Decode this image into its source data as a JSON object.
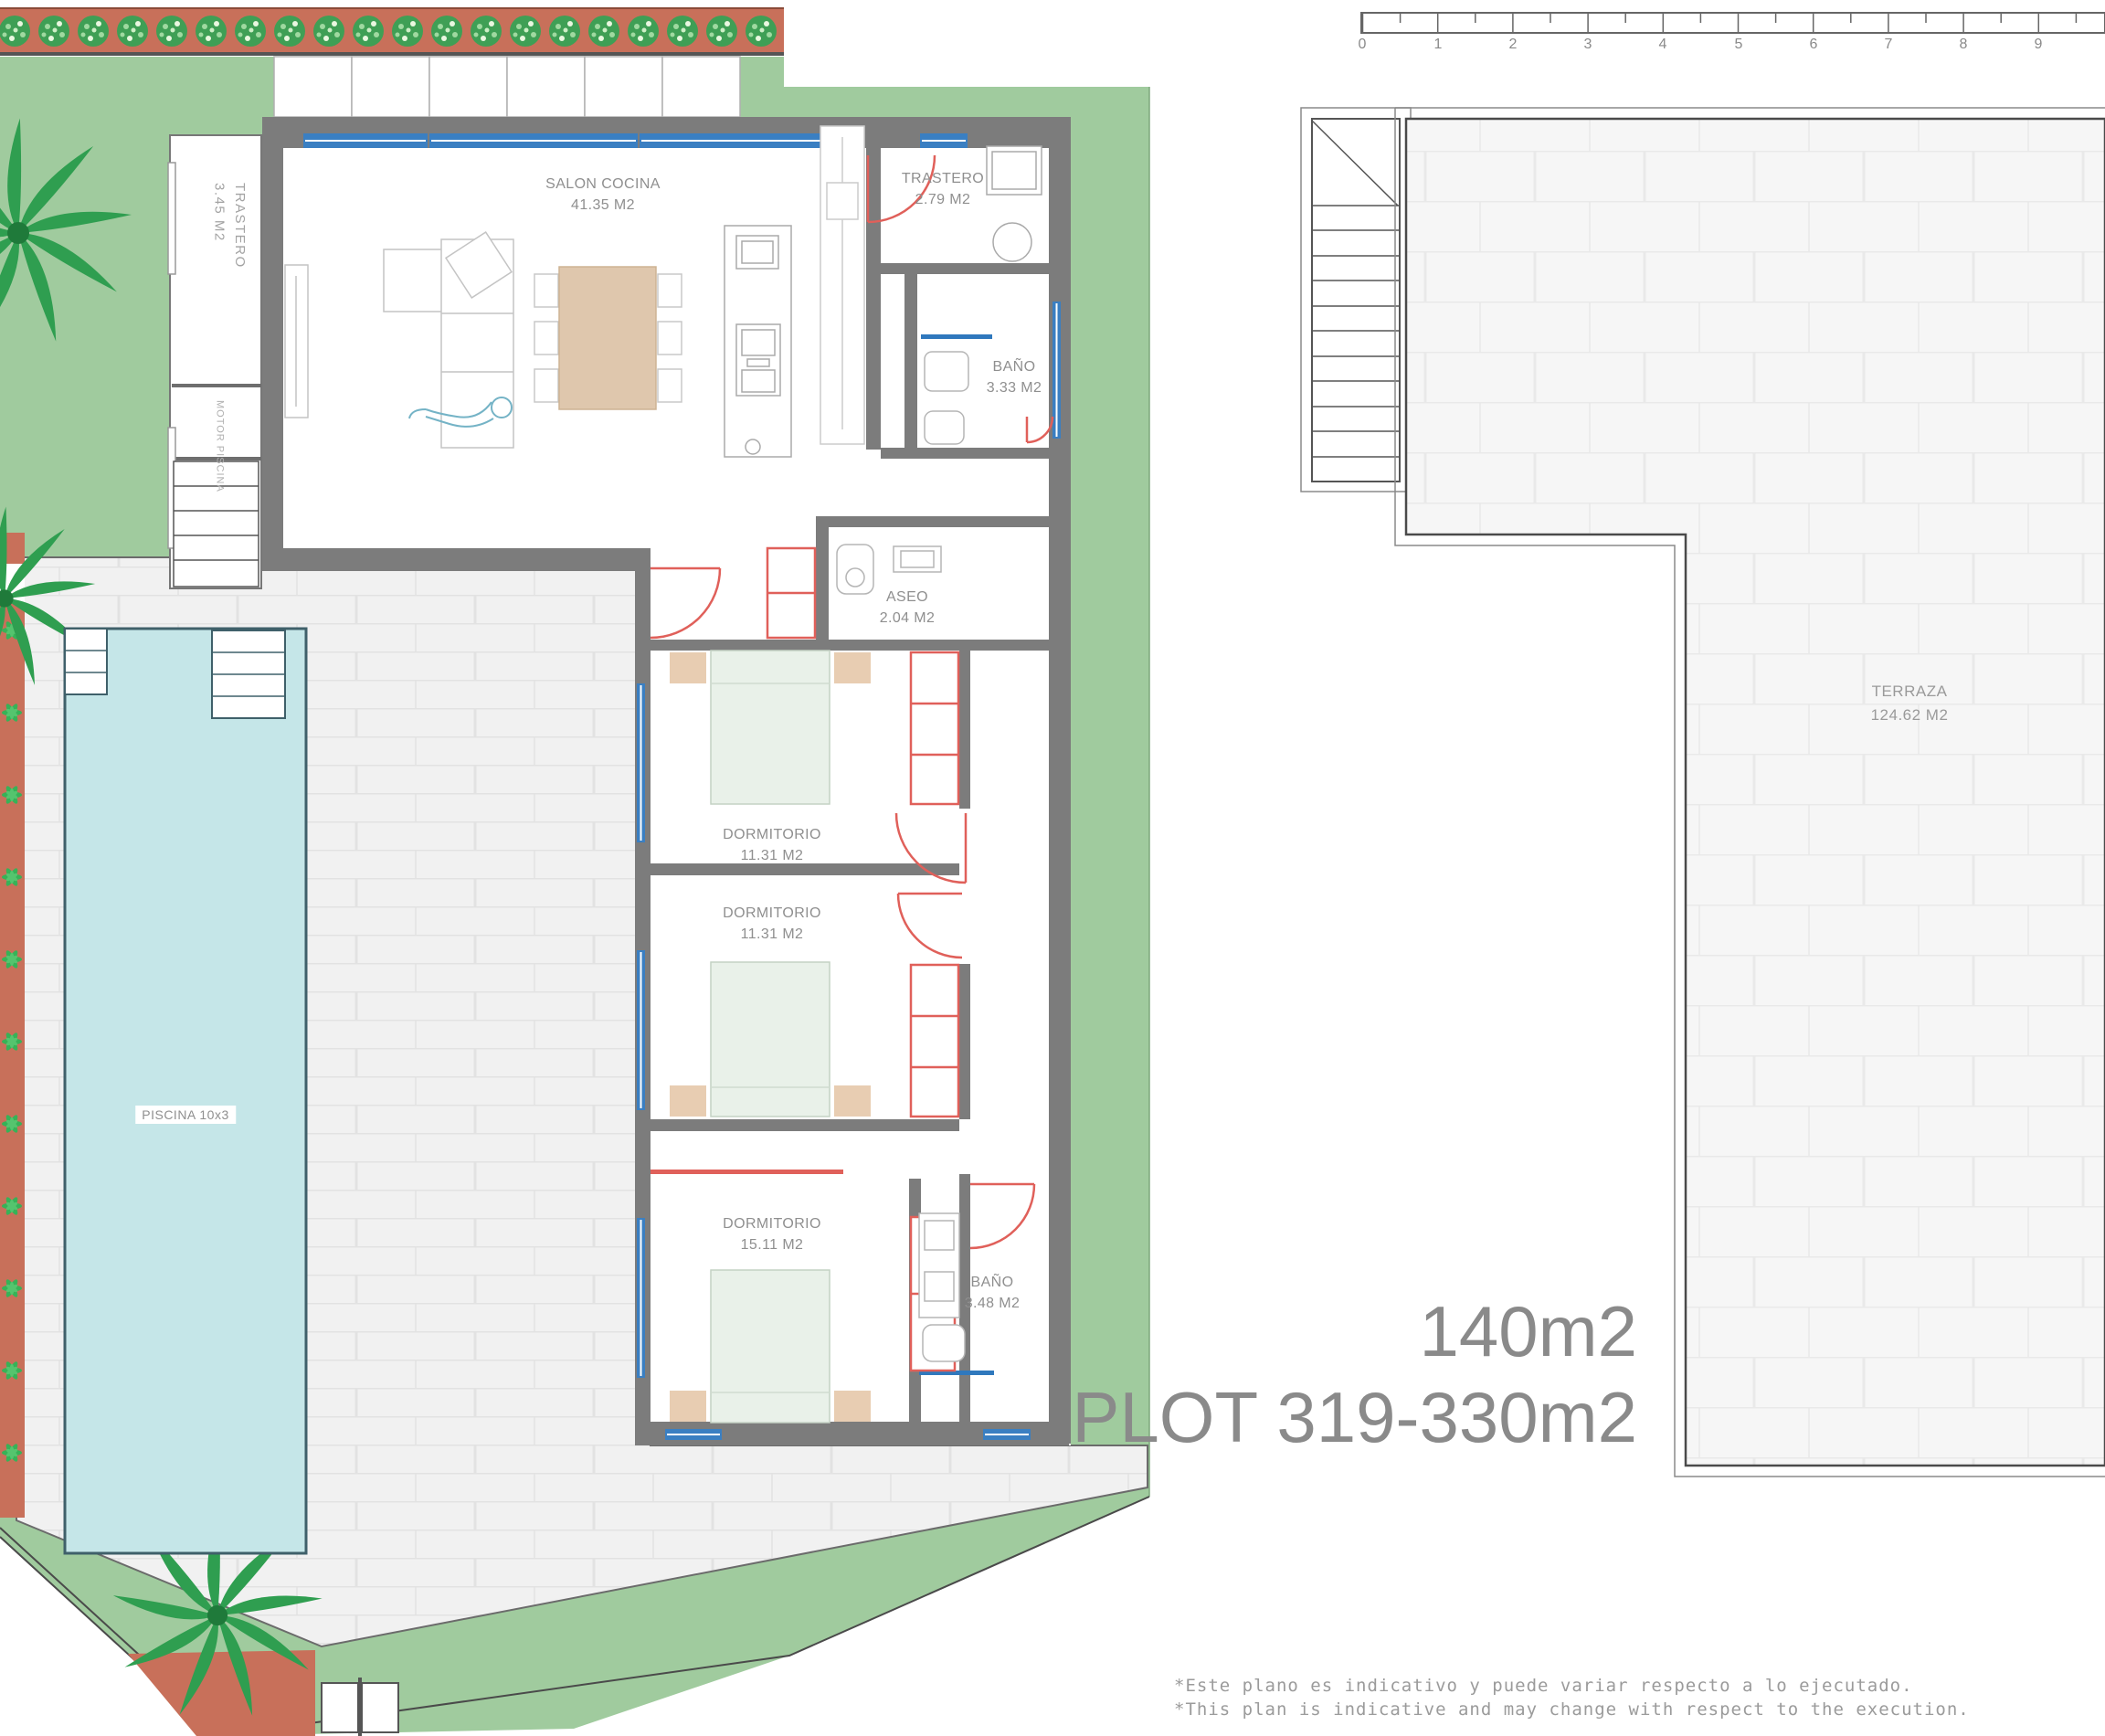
{
  "left_plan": {
    "rooms": {
      "salon": {
        "name": "SALON COCINA",
        "area": "41.35 M2"
      },
      "trastero_top": {
        "name": "TRASTERO",
        "area": "2.79 M2"
      },
      "bano_top": {
        "name": "BAÑO",
        "area": "3.33 M2"
      },
      "aseo": {
        "name": "ASEO",
        "area": "2.04 M2"
      },
      "dorm1": {
        "name": "DORMITORIO",
        "area": "11.31 M2"
      },
      "dorm2": {
        "name": "DORMITORIO",
        "area": "11.31 M2"
      },
      "dorm3": {
        "name": "DORMITORIO",
        "area": "15.11 M2"
      },
      "bano_bottom": {
        "name": "BAÑO",
        "area": "3.48 M2"
      },
      "trastero_left": {
        "name": "TRASTERO",
        "area": "3.45 M2"
      },
      "motor_piscina": {
        "name": "MOTOR PISCINA"
      },
      "piscina": {
        "name": "PISCINA 10x3"
      }
    }
  },
  "right_plan": {
    "terraza": {
      "name": "TERRAZA",
      "area": "124.62 M2"
    },
    "size_label": "140m2",
    "plot_label": "PLOT 319-330m2",
    "ruler": {
      "numbers": [
        "0",
        "1",
        "2",
        "3",
        "4",
        "5",
        "6",
        "7",
        "8",
        "9"
      ]
    }
  },
  "footer": {
    "disclaimer_es": "*Este plano es indicativo y puede variar respecto a lo ejecutado.",
    "disclaimer_en": "*This plan is indicative and may change with respect to the execution."
  },
  "colors": {
    "lawn": "#a0cb9e",
    "hedge": "#c8705a",
    "pool": "#c5e6e8",
    "wall": "#7c7c7c",
    "window_blue": "#3a7fc2",
    "door_red": "#e0605a",
    "label_gray": "#8f8f8f",
    "big_text_gray": "#8a8a8a"
  }
}
